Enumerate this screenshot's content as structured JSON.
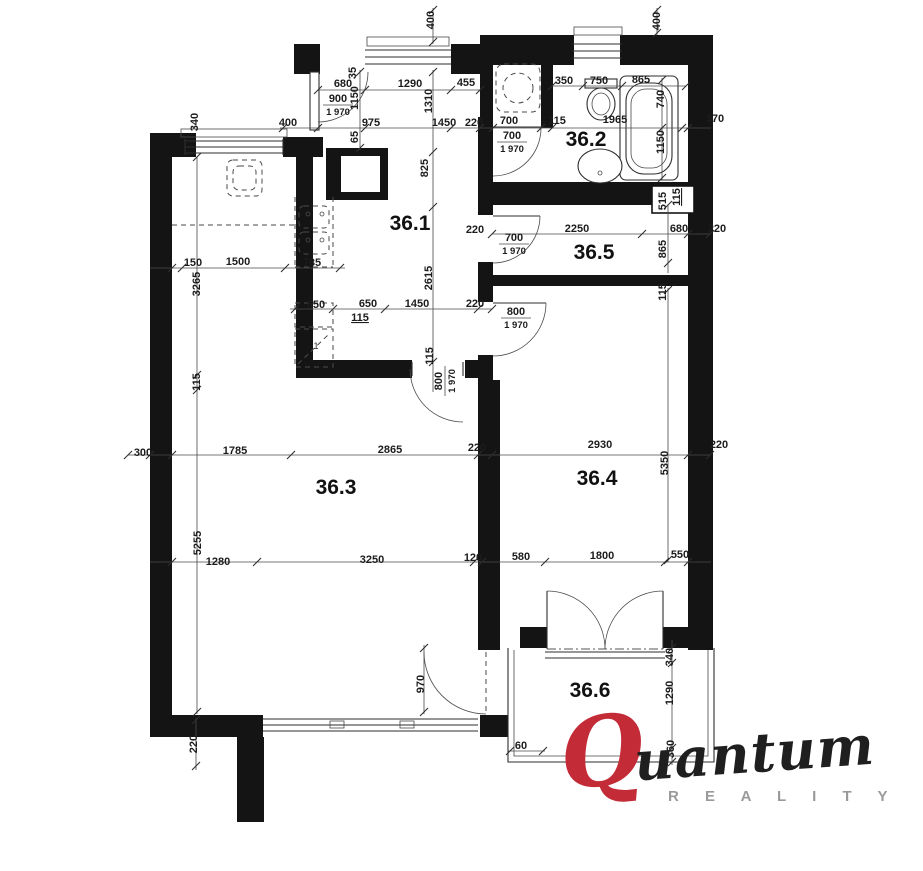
{
  "page": {
    "background": "#ffffff"
  },
  "floorplan": {
    "wall_color": "#141414",
    "line_color": "#2e2e2e",
    "rooms": [
      {
        "id": "room-36-1",
        "label": "36.1",
        "x": 410,
        "y": 230
      },
      {
        "id": "room-36-2",
        "label": "36.2",
        "x": 586,
        "y": 146
      },
      {
        "id": "room-36-3",
        "label": "36.3",
        "x": 336,
        "y": 494
      },
      {
        "id": "room-36-4",
        "label": "36.4",
        "x": 597,
        "y": 485
      },
      {
        "id": "room-36-5",
        "label": "36.5",
        "x": 594,
        "y": 259
      },
      {
        "id": "room-36-6",
        "label": "36.6",
        "x": 590,
        "y": 697
      }
    ],
    "dimensions": [
      {
        "t": "680",
        "x": 343,
        "y": 83
      },
      {
        "t": "1290",
        "x": 410,
        "y": 83
      },
      {
        "t": "455",
        "x": 466,
        "y": 82
      },
      {
        "t": "350",
        "x": 564,
        "y": 80
      },
      {
        "t": "750",
        "x": 599,
        "y": 80
      },
      {
        "t": "865",
        "x": 641,
        "y": 79
      },
      {
        "t": "400",
        "x": 288,
        "y": 122
      },
      {
        "t": "975",
        "x": 371,
        "y": 122
      },
      {
        "t": "1450",
        "x": 444,
        "y": 122
      },
      {
        "t": "220",
        "x": 474,
        "y": 122
      },
      {
        "t": "700",
        "x": 509,
        "y": 120
      },
      {
        "t": "115",
        "x": 557,
        "y": 120
      },
      {
        "t": "1965",
        "x": 615,
        "y": 119
      },
      {
        "t": "370",
        "x": 715,
        "y": 118
      },
      {
        "t": "400",
        "x": 430,
        "y": 20,
        "r": -90
      },
      {
        "t": "400",
        "x": 656,
        "y": 21,
        "r": -90
      },
      {
        "t": "340",
        "x": 194,
        "y": 122,
        "r": -90
      },
      {
        "t": "1150",
        "x": 354,
        "y": 98,
        "r": -90
      },
      {
        "t": "35",
        "x": 352,
        "y": 73,
        "r": -90
      },
      {
        "t": "65",
        "x": 354,
        "y": 137,
        "r": -90
      },
      {
        "t": "1310",
        "x": 428,
        "y": 101,
        "r": -90
      },
      {
        "t": "825",
        "x": 424,
        "y": 168,
        "r": -90
      },
      {
        "t": "740",
        "x": 660,
        "y": 99,
        "r": -90
      },
      {
        "t": "1150",
        "x": 660,
        "y": 142,
        "r": -90
      },
      {
        "t": "900",
        "t2": "1 970",
        "x": 338,
        "y": 104
      },
      {
        "t": "700",
        "t2": "1 970",
        "x": 512,
        "y": 141
      },
      {
        "t": "515",
        "x": 662,
        "y": 201,
        "r": -90
      },
      {
        "t": "115",
        "x": 676,
        "y": 197,
        "r": -90,
        "u": true
      },
      {
        "t": "220",
        "x": 475,
        "y": 229
      },
      {
        "t": "2250",
        "x": 577,
        "y": 228
      },
      {
        "t": "680",
        "x": 679,
        "y": 228
      },
      {
        "t": "220",
        "x": 717,
        "y": 228
      },
      {
        "t": "700",
        "t2": "1 970",
        "x": 514,
        "y": 243
      },
      {
        "t": "865",
        "x": 662,
        "y": 249,
        "r": -90
      },
      {
        "t": "115",
        "x": 662,
        "y": 292,
        "r": -90
      },
      {
        "t": "2615",
        "x": 428,
        "y": 278,
        "r": -90
      },
      {
        "t": "150",
        "x": 193,
        "y": 262
      },
      {
        "t": "1500",
        "x": 238,
        "y": 261
      },
      {
        "t": "785",
        "x": 312,
        "y": 262
      },
      {
        "t": "3265",
        "x": 196,
        "y": 284,
        "r": -90
      },
      {
        "t": "650",
        "x": 316,
        "y": 304
      },
      {
        "t": "650",
        "x": 368,
        "y": 303
      },
      {
        "t": "1450",
        "x": 417,
        "y": 303
      },
      {
        "t": "220",
        "x": 475,
        "y": 303
      },
      {
        "t": "115",
        "x": 360,
        "y": 317,
        "u": true
      },
      {
        "t": "800",
        "t2": "1 970",
        "x": 516,
        "y": 317
      },
      {
        "t": "115",
        "x": 196,
        "y": 382,
        "r": -90
      },
      {
        "t": "115",
        "x": 429,
        "y": 356,
        "r": -90
      },
      {
        "t": "800",
        "t2": "1 970",
        "x": 444,
        "y": 381,
        "r": -90
      },
      {
        "t": "300",
        "x": 143,
        "y": 452
      },
      {
        "t": "1785",
        "x": 235,
        "y": 450
      },
      {
        "t": "2865",
        "x": 390,
        "y": 449
      },
      {
        "t": "220",
        "x": 477,
        "y": 447
      },
      {
        "t": "2930",
        "x": 600,
        "y": 444
      },
      {
        "t": "220",
        "x": 719,
        "y": 444
      },
      {
        "t": "5255",
        "x": 197,
        "y": 543,
        "r": -90
      },
      {
        "t": "5350",
        "x": 664,
        "y": 463,
        "r": -90
      },
      {
        "t": "1280",
        "x": 218,
        "y": 561
      },
      {
        "t": "3250",
        "x": 372,
        "y": 559
      },
      {
        "t": "120",
        "x": 473,
        "y": 557
      },
      {
        "t": "580",
        "x": 521,
        "y": 556
      },
      {
        "t": "1800",
        "x": 602,
        "y": 555
      },
      {
        "t": "550",
        "x": 680,
        "y": 554
      },
      {
        "t": "970",
        "x": 420,
        "y": 684,
        "r": -90
      },
      {
        "t": "220",
        "x": 193,
        "y": 744,
        "r": -90
      },
      {
        "t": "340",
        "x": 669,
        "y": 657,
        "r": -90
      },
      {
        "t": "1290",
        "x": 669,
        "y": 693,
        "r": -90
      },
      {
        "t": "360",
        "x": 670,
        "y": 749,
        "r": -90
      },
      {
        "t": "60",
        "x": 521,
        "y": 745
      }
    ],
    "fixture_marks": [
      {
        "t": "1",
        "x": 316,
        "y": 349
      }
    ]
  },
  "logo": {
    "q": "Q",
    "name_rest": "uantum",
    "subtitle": "R E A L I T Y",
    "q_color": "#c32b37",
    "text_color": "#1f1f1f",
    "subtitle_color": "#9a9a9a"
  }
}
